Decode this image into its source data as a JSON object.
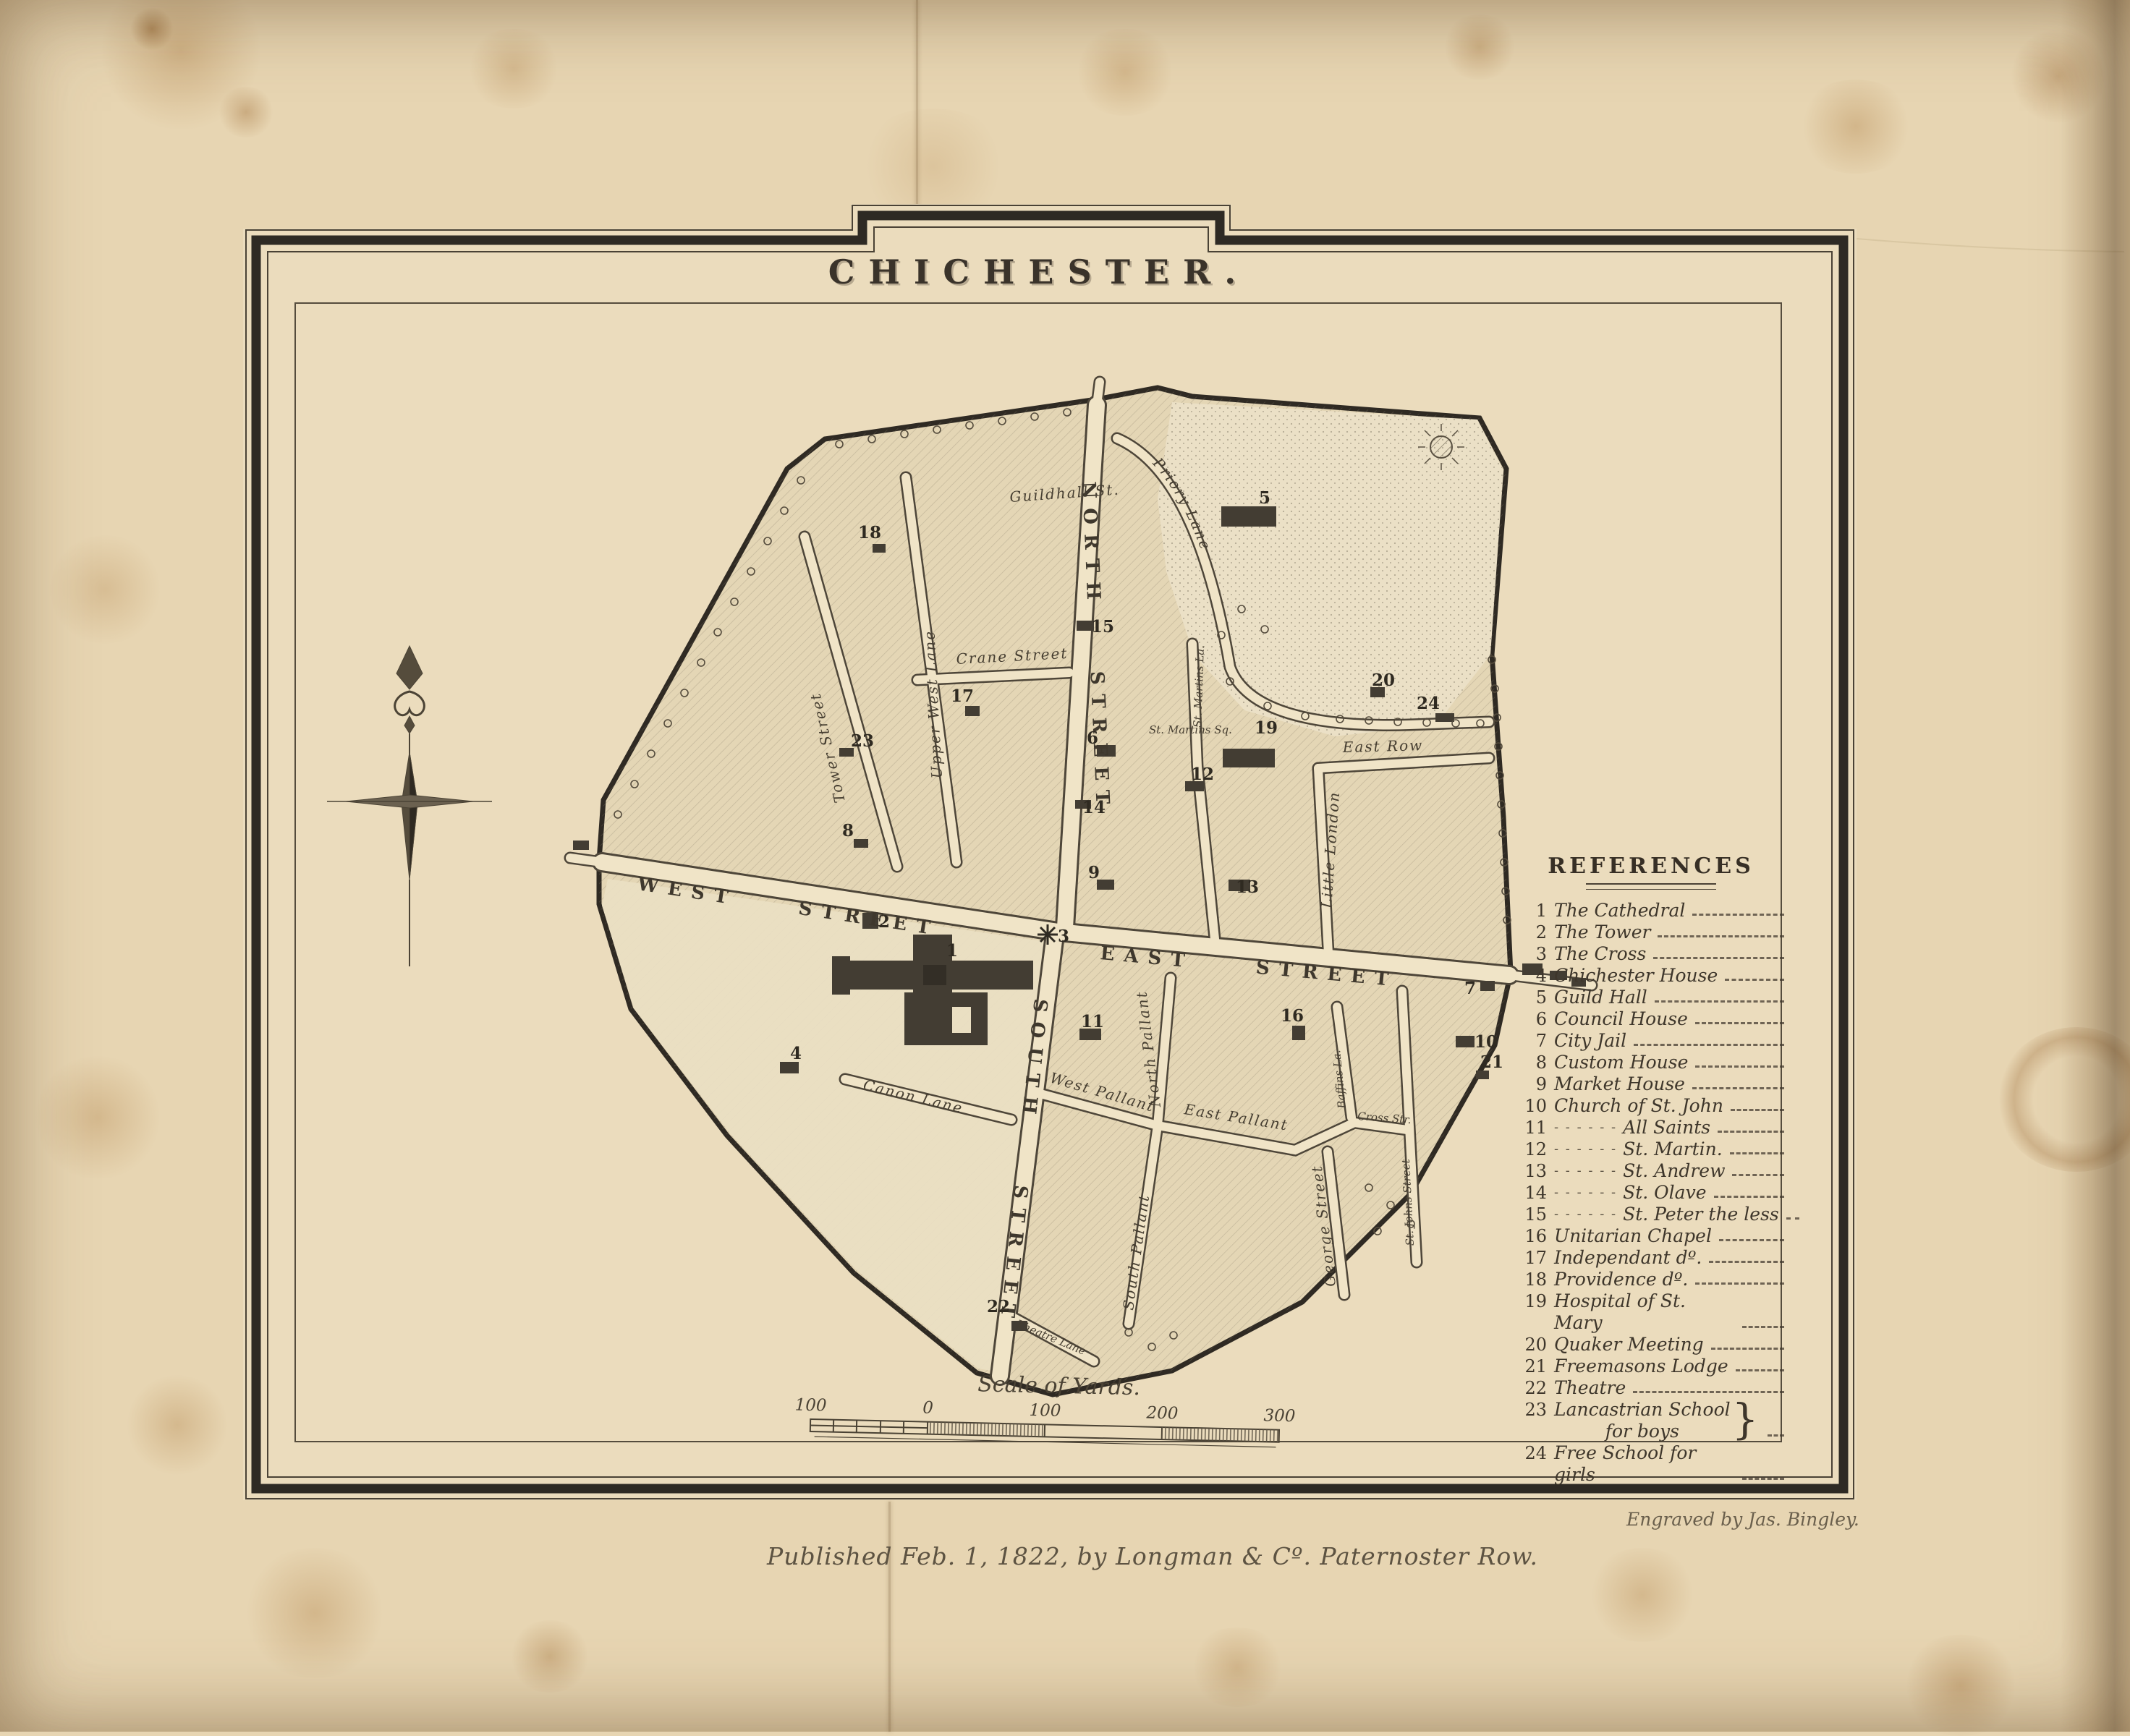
{
  "title": "CHICHESTER.",
  "references": {
    "title": "REFERENCES",
    "items": [
      {
        "n": "1",
        "label": "The Cathedral"
      },
      {
        "n": "2",
        "label": "The Tower"
      },
      {
        "n": "3",
        "label": "The Cross"
      },
      {
        "n": "4",
        "label": "Chichester House"
      },
      {
        "n": "5",
        "label": "Guild Hall"
      },
      {
        "n": "6",
        "label": "Council House"
      },
      {
        "n": "7",
        "label": "City Jail"
      },
      {
        "n": "8",
        "label": "Custom House"
      },
      {
        "n": "9",
        "label": "Market House"
      },
      {
        "n": "10",
        "label": "Church of St. John"
      },
      {
        "n": "11",
        "pre": "- - - - - -",
        "label": "All Saints"
      },
      {
        "n": "12",
        "pre": "- - - - - -",
        "label": "St. Martin."
      },
      {
        "n": "13",
        "pre": "- - - - - -",
        "label": "St. Andrew"
      },
      {
        "n": "14",
        "pre": "- - - - - -",
        "label": "St. Olave"
      },
      {
        "n": "15",
        "pre": "- - - - - -",
        "label": "St. Peter the less"
      },
      {
        "n": "16",
        "label": "Unitarian Chapel"
      },
      {
        "n": "17",
        "label": "Independant dº."
      },
      {
        "n": "18",
        "label": "Providence dº."
      },
      {
        "n": "19",
        "label": "Hospital of St. Mary"
      },
      {
        "n": "20",
        "label": "Quaker Meeting"
      },
      {
        "n": "21",
        "label": "Freemasons Lodge"
      },
      {
        "n": "22",
        "label": "Theatre"
      },
      {
        "n": "23",
        "label": "Lancastrian School",
        "label2": "for boys",
        "brace": "}"
      },
      {
        "n": "24",
        "label": "Free School for girls"
      }
    ]
  },
  "scale_bar": {
    "caption": "Scale of Yards.",
    "ticks": [
      "100",
      "0",
      "100",
      "200",
      "300"
    ]
  },
  "imprint": {
    "published": "Published Feb. 1, 1822, by Longman & Cº. Paternoster Row.",
    "engraved": "Engraved by Jas. Bingley."
  },
  "map": {
    "streets": {
      "west_street": "WEST STREET",
      "east_street": "EAST STREET",
      "north_street": "NORTH STREET",
      "south_street": "SOUTH STREET",
      "tower_street": "Tower Street",
      "upper_west_lane": "Upper West Lane",
      "crane_street": "Crane Street",
      "guildhall_st": "Guildhall St.",
      "priory_lane": "Priory Lane",
      "st_martins_sq": "St. Martins Sq.",
      "st_martins_la": "St. Martins La.",
      "little_london": "Little London",
      "east_row": "East Row",
      "west_pallant": "West Pallant",
      "north_pallant": "North Pallant",
      "east_pallant": "East Pallant",
      "south_pallant": "South Pallant",
      "george_street": "George Street",
      "baffins_lane": "Baffins La.",
      "cross_str": "Cross Str.",
      "st_johns_street": "St. Johns Street",
      "canon_lane": "Canon Lane",
      "theatre_lane": "Theatre Lane"
    },
    "markers": [
      "1",
      "2",
      "3",
      "4",
      "5",
      "6",
      "7",
      "8",
      "9",
      "10",
      "11",
      "12",
      "13",
      "14",
      "15",
      "16",
      "17",
      "18",
      "19",
      "20",
      "21",
      "22",
      "23",
      "24"
    ]
  },
  "colors": {
    "paper": "#e7d5b2",
    "plate_paper": "#ebdcbd",
    "ink": "#35302a",
    "map_ink": "#4e4639",
    "stain": "#b98f55"
  }
}
